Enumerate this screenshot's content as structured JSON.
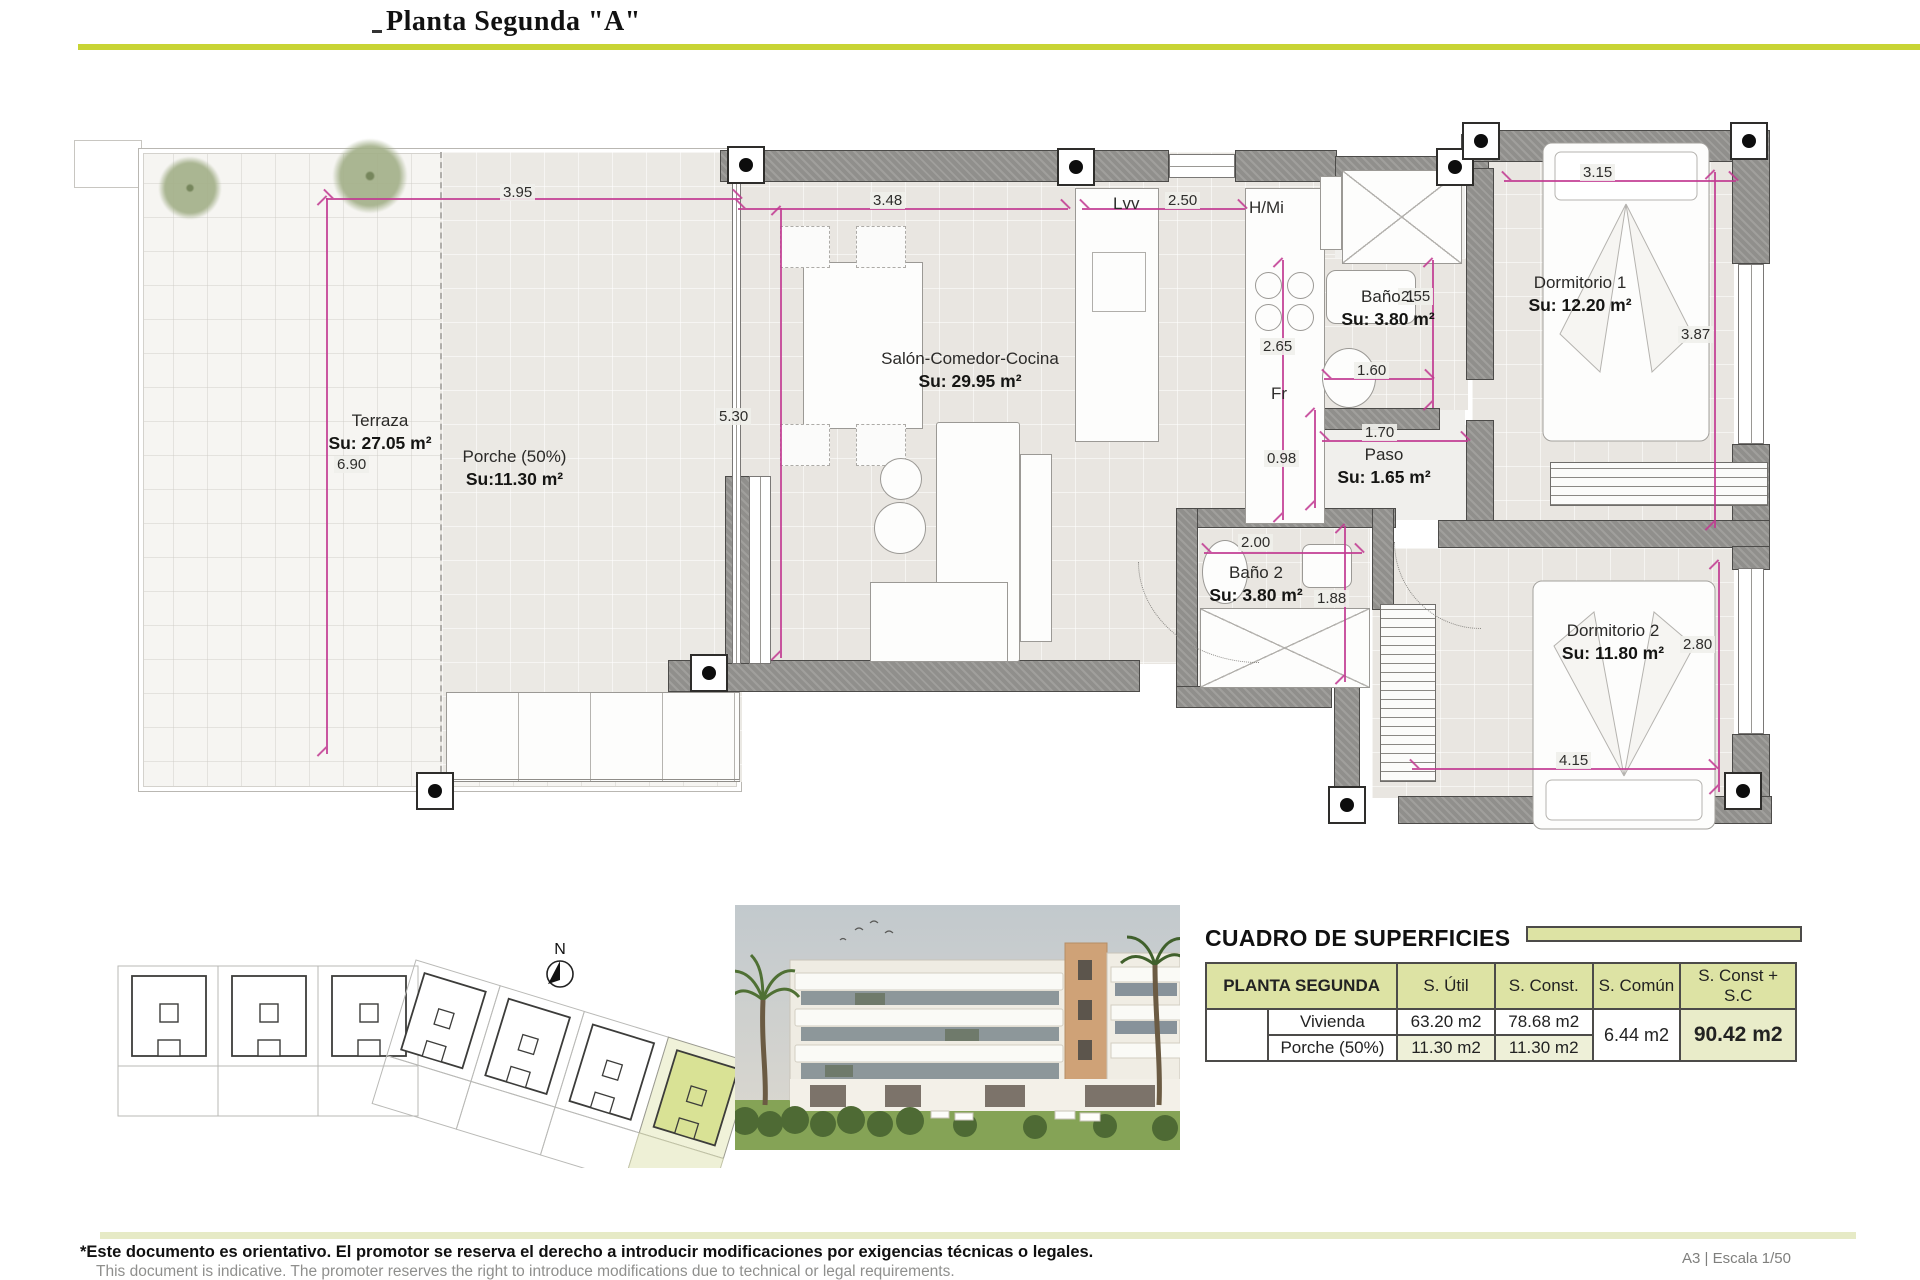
{
  "title": "Planta Segunda \"A\"",
  "plan": {
    "rooms": {
      "terraza": {
        "name": "Terraza",
        "area": "Su: 27.05 m²"
      },
      "porche": {
        "name": "Porche (50%)",
        "area": "Su:11.30 m²"
      },
      "salon": {
        "name": "Salón-Comedor-Cocina",
        "area": "Su: 29.95 m²"
      },
      "bano1": {
        "name": "Baño 1",
        "area": "Su: 3.80 m²"
      },
      "dormitorio1": {
        "name": "Dormitorio 1",
        "area": "Su: 12.20 m²"
      },
      "paso": {
        "name": "Paso",
        "area": "Su: 1.65 m²"
      },
      "bano2": {
        "name": "Baño 2",
        "area": "Su: 3.80 m²"
      },
      "dormitorio2": {
        "name": "Dormitorio 2",
        "area": "Su: 11.80 m²"
      }
    },
    "appliances": {
      "dishwasher": "Lvv",
      "oven_micro": "H/Mi",
      "fridge": "Fr"
    },
    "dims": {
      "terraza_w": "3.95",
      "terraza_h": "6.90",
      "salon_w": "3.48",
      "salon_h": "5.30",
      "kitchen_w": "2.50",
      "kitchen_h": "2.65",
      "bano1_h": "2.55",
      "bano1_w": "1.60",
      "paso_w": "1.70",
      "paso_h": "0.98",
      "bano2_w": "2.00",
      "bano2_h": "1.88",
      "dorm1_w": "3.15",
      "dorm1_h": "3.87",
      "dorm2_w": "4.15",
      "dorm2_h": "2.80"
    },
    "north": "N"
  },
  "surfaces_table": {
    "title": "CUADRO DE SUPERFICIES",
    "col_headers": {
      "planta": "PLANTA SEGUNDA",
      "util": "S. Útil",
      "const": "S. Const.",
      "comun": "S. Común",
      "total": "S. Const + S.C"
    },
    "rows": [
      {
        "label": "Vivienda",
        "util": "63.20 m2",
        "const": "78.68 m2"
      },
      {
        "label": "Porche (50%)",
        "util": "11.30 m2",
        "const": "11.30 m2"
      }
    ],
    "comun": "6.44 m2",
    "total": "90.42 m2"
  },
  "footer": {
    "disclaimer_es": "*Este documento es orientativo. El promotor se reserva el derecho a introducir modificaciones por exigencias técnicas o legales.",
    "disclaimer_en": "This document is indicative. The promoter reserves the right to introduce modifications due to technical or legal requirements.",
    "sheet": "A3 | Escala 1/50"
  }
}
